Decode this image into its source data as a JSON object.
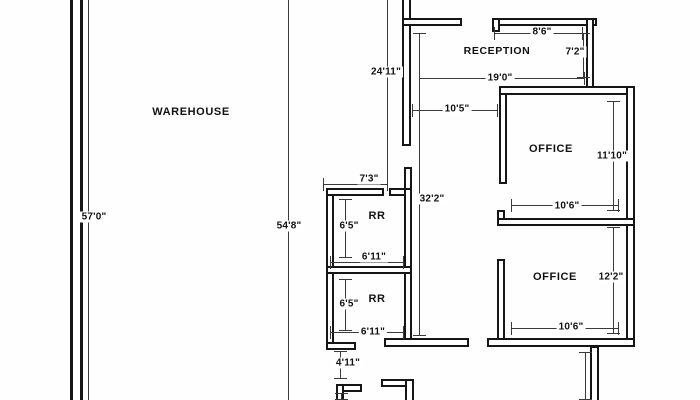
{
  "plan": {
    "rooms": {
      "warehouse": {
        "label": "WAREHOUSE"
      },
      "reception": {
        "label": "RECEPTION"
      },
      "office_upper": {
        "label": "OFFICE"
      },
      "office_lower": {
        "label": "OFFICE"
      },
      "rr_upper": {
        "label": "RR"
      },
      "rr_lower": {
        "label": "RR"
      }
    },
    "dims": {
      "left_height": "57'0\"",
      "mid_height": "54'8\"",
      "upper_left_height": "24'11\"",
      "section_height": "32'2\"",
      "reception_width": "19'0\"",
      "corridor_width": "10'5\"",
      "reception_right_width": "8'6\"",
      "reception_right_height": "7'2\"",
      "rr_top_width": "7'3\"",
      "rr_upper_height": "6'5\"",
      "rr_upper_width": "6'11\"",
      "rr_lower_height": "6'5\"",
      "rr_lower_width": "6'11\"",
      "hall_height": "4'11\"",
      "office_upper_height": "11'10\"",
      "office_upper_width": "10'6\"",
      "office_lower_height": "12'2\"",
      "office_lower_width": "10'6\""
    }
  }
}
